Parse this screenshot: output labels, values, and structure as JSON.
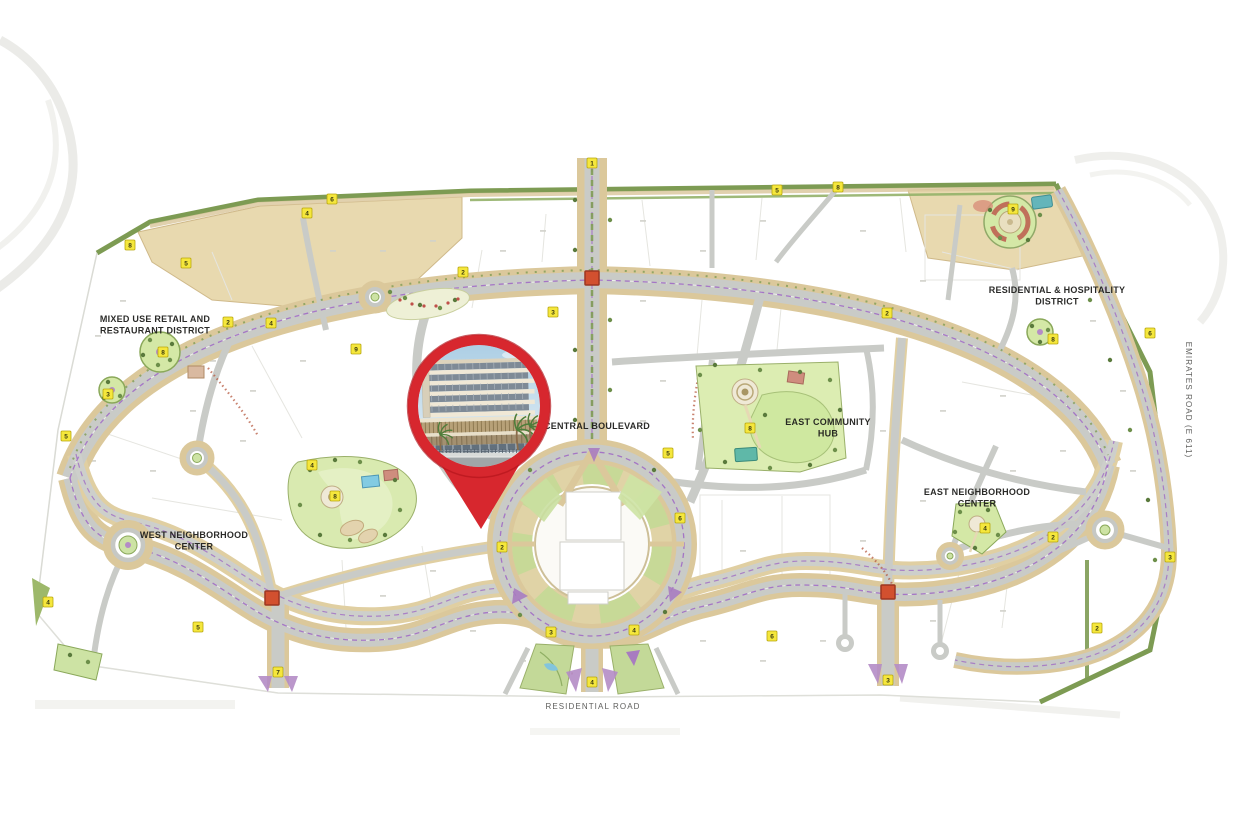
{
  "page": {
    "background": "#ffffff",
    "width": 1236,
    "height": 824,
    "kind": "development master plan map"
  },
  "map": {
    "type": "master-plan",
    "colors": {
      "pin_red": "#d7272e",
      "road_grey": "#c9cbc7",
      "landscape_tan": "#dbc89b",
      "boundary_green": "#7d9b53",
      "lawn_green": "#cde3a4",
      "marker_yellow": "#f5e73c",
      "junction_red": "#d2502f",
      "cycle_track_purple": "#a06cc4"
    },
    "district_labels": [
      {
        "id": "mixed-use-retail",
        "lines": [
          "MIXED USE RETAIL AND",
          "RESTAURANT DISTRICT"
        ],
        "x": 155,
        "y": 322
      },
      {
        "id": "residential-hospitality",
        "lines": [
          "RESIDENTIAL & HOSPITALITY",
          "DISTRICT"
        ],
        "x": 1057,
        "y": 293
      },
      {
        "id": "central-boulevard",
        "lines": [
          "CENTRAL BOULEVARD"
        ],
        "x": 597,
        "y": 429
      },
      {
        "id": "east-community-hub",
        "lines": [
          "EAST COMMUNITY",
          "HUB"
        ],
        "x": 828,
        "y": 425
      },
      {
        "id": "east-neighborhood-center",
        "lines": [
          "EAST NEIGHBORHOOD",
          "CENTER"
        ],
        "x": 977,
        "y": 495
      },
      {
        "id": "west-neighborhood-center",
        "lines": [
          "WEST NEIGHBORHOOD",
          "CENTER"
        ],
        "x": 194,
        "y": 538
      }
    ],
    "road_labels": {
      "residential_road": {
        "text": "RESIDENTIAL ROAD",
        "x": 593,
        "y": 709
      },
      "emirates_road": {
        "text": "EMIRATES ROAD (E 611)",
        "x": 1186,
        "y": 400,
        "rotation": 90
      }
    },
    "markers": [
      {
        "n": "8",
        "x": 130,
        "y": 245
      },
      {
        "n": "5",
        "x": 186,
        "y": 263
      },
      {
        "n": "4",
        "x": 307,
        "y": 213
      },
      {
        "n": "6",
        "x": 332,
        "y": 199
      },
      {
        "n": "2",
        "x": 463,
        "y": 272
      },
      {
        "n": "3",
        "x": 553,
        "y": 312
      },
      {
        "n": "1",
        "x": 592,
        "y": 163
      },
      {
        "n": "2",
        "x": 228,
        "y": 322
      },
      {
        "n": "8",
        "x": 163,
        "y": 352
      },
      {
        "n": "3",
        "x": 108,
        "y": 394
      },
      {
        "n": "5",
        "x": 66,
        "y": 436
      },
      {
        "n": "4",
        "x": 48,
        "y": 602
      },
      {
        "n": "5",
        "x": 198,
        "y": 627
      },
      {
        "n": "4",
        "x": 271,
        "y": 323
      },
      {
        "n": "9",
        "x": 356,
        "y": 349
      },
      {
        "n": "4",
        "x": 312,
        "y": 465
      },
      {
        "n": "8",
        "x": 335,
        "y": 496
      },
      {
        "n": "2",
        "x": 502,
        "y": 547
      },
      {
        "n": "3",
        "x": 551,
        "y": 632
      },
      {
        "n": "4",
        "x": 634,
        "y": 630
      },
      {
        "n": "5",
        "x": 668,
        "y": 453
      },
      {
        "n": "6",
        "x": 680,
        "y": 518
      },
      {
        "n": "8",
        "x": 750,
        "y": 428
      },
      {
        "n": "2",
        "x": 887,
        "y": 313
      },
      {
        "n": "9",
        "x": 1013,
        "y": 209
      },
      {
        "n": "8",
        "x": 1053,
        "y": 339
      },
      {
        "n": "6",
        "x": 1150,
        "y": 333
      },
      {
        "n": "4",
        "x": 985,
        "y": 528
      },
      {
        "n": "2",
        "x": 1053,
        "y": 537
      },
      {
        "n": "2",
        "x": 1097,
        "y": 628
      },
      {
        "n": "3",
        "x": 1170,
        "y": 557
      },
      {
        "n": "6",
        "x": 772,
        "y": 636
      },
      {
        "n": "5",
        "x": 777,
        "y": 190
      },
      {
        "n": "8",
        "x": 838,
        "y": 187
      },
      {
        "n": "7",
        "x": 278,
        "y": 672
      },
      {
        "n": "4",
        "x": 592,
        "y": 682
      },
      {
        "n": "3",
        "x": 888,
        "y": 680
      }
    ]
  },
  "pin": {
    "icon": "location-pin-icon",
    "color": "#d7272e",
    "x": 479,
    "y": 406,
    "tip_y": 528,
    "photo": {
      "subject": "mid-rise residential building with retail podium",
      "sky": "#a8cce3"
    }
  }
}
